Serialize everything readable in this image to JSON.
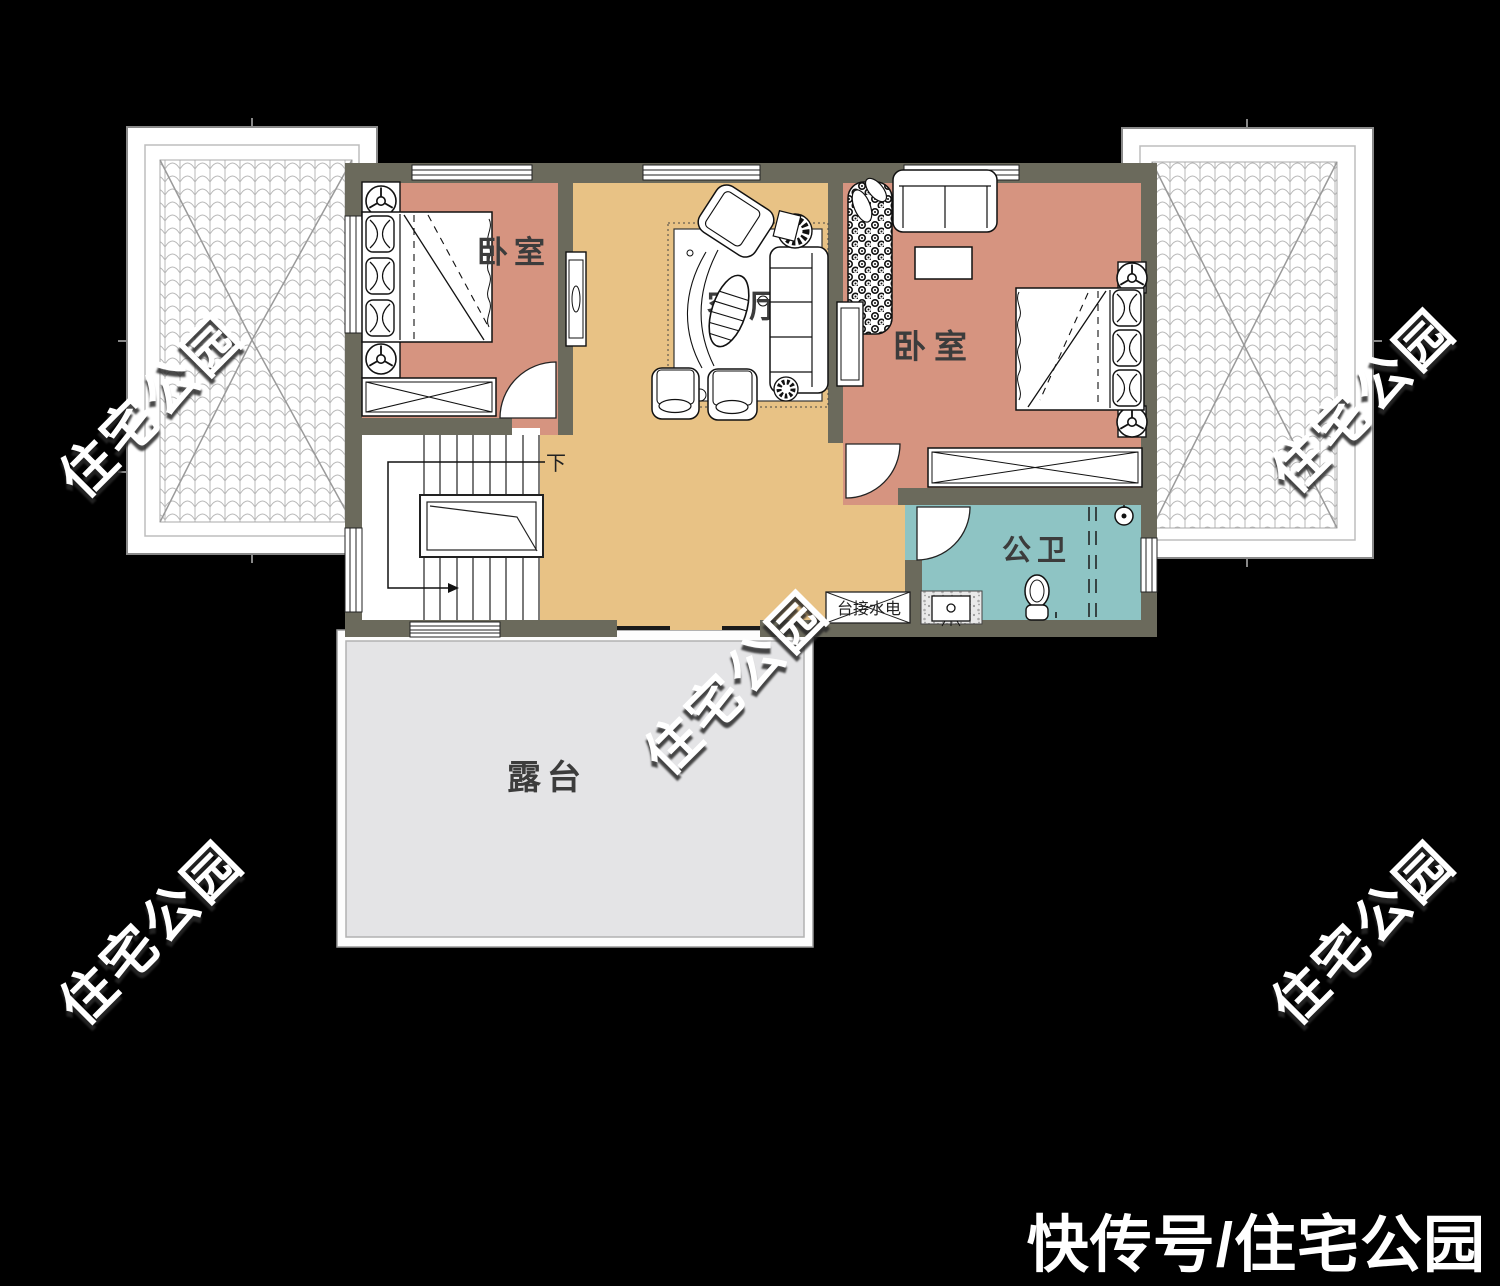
{
  "colors": {
    "background": "#000000",
    "wall": "#6b6a5c",
    "bedroom_floor": "#d69480",
    "living_floor": "#e8c285",
    "bathroom_floor": "#8ec4c4",
    "terrace_floor": "#e4e4e6",
    "stair_floor": "#ffffff",
    "roof_panel": "#ffffff"
  },
  "rooms": {
    "bedroom_left": {
      "label": "卧室"
    },
    "living_room": {
      "label": "客厅"
    },
    "bedroom_right": {
      "label": "卧室"
    },
    "bathroom": {
      "label": "公卫"
    },
    "terrace": {
      "label": "露台"
    }
  },
  "stairs": {
    "direction_label": "下"
  },
  "laundry": {
    "label": "台接水电"
  },
  "watermark": {
    "text": "住宅公园"
  },
  "caption": {
    "text": "快传号/住宅公园"
  }
}
